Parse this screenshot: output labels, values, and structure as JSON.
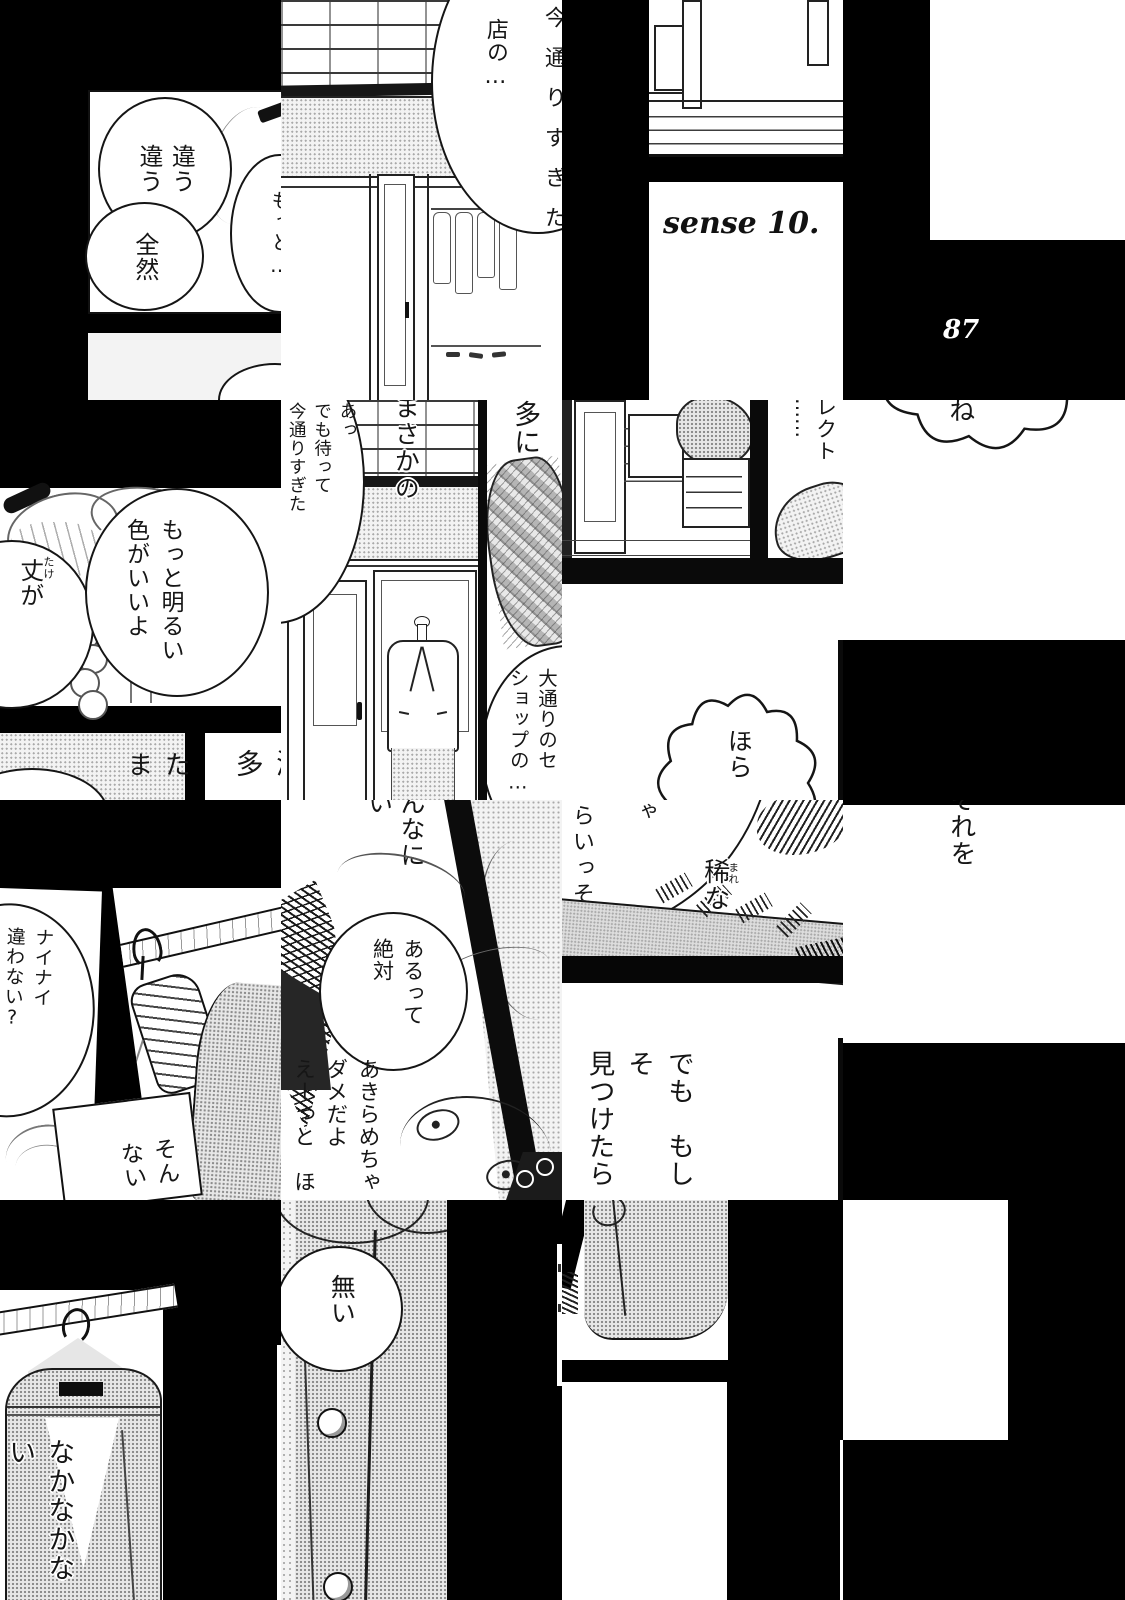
{
  "page": {
    "number": "87",
    "episode": "sense 10."
  },
  "speech": {
    "chigau": "違う\n違う",
    "zenzen": "全然",
    "motto": "もっと…",
    "mise": "店の…",
    "ima_clip": "今通りすぎた",
    "take": "丈が",
    "take_furi": "たけ",
    "akarui": "もっと明るい\n色がいいよ",
    "tama": "たま",
    "metta": "滅多",
    "masaka": "まさかの",
    "atte": "あっ\nでも待って\n今通りすぎた",
    "tani": "多に",
    "oodori": "大通りのセ\nショップの…",
    "dots": "……",
    "rekuto": "レクト",
    "ne": "ね",
    "hora": "ほら",
    "nainai": "ナイナイ\n違わない?",
    "son": "そん\nない",
    "nnani": "んなに\nい",
    "arutte": "あるって\n絶対",
    "akirame": "あきらめちゃ\nダメだよ\nえーっと　ほ",
    "ya": "ゃ",
    "raiisso": "らいっそ",
    "mare": "稀な",
    "mare_furi": "まれ",
    "demo": "でも　もしそ\n見つけたら",
    "sorewo": "それを",
    "nakanaka": "なかなかない",
    "nai": "無い"
  }
}
